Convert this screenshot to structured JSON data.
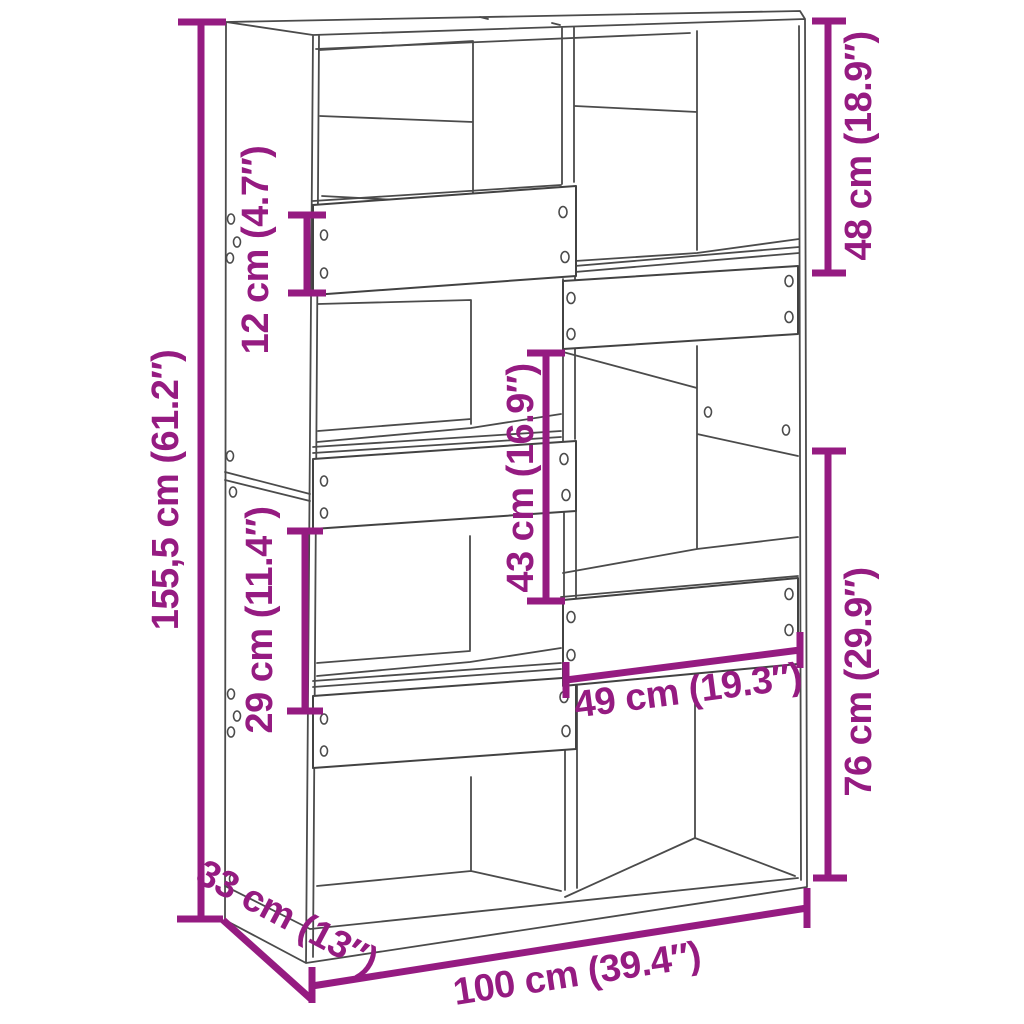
{
  "diagram": {
    "title": "room-divider bookcase dimension drawing",
    "accent_color": "#951B81",
    "line_color": "#4b4b4b",
    "background_color": "#ffffff",
    "unit_system": "cm / inches"
  },
  "dimensions": {
    "overall_height": "155,5 cm (61.2″)",
    "upper_left_gap": "12 cm (4.7″)",
    "upper_right_compartment": "48 cm (18.9″)",
    "middle_compartment": "43 cm (16.9″)",
    "middle_left_compartment": "29 cm (11.4″)",
    "lower_right_compartment": "76 cm (29.9″)",
    "inner_width": "49 cm (19.3″)",
    "depth": "33 cm (13″)",
    "overall_width": "100 cm (39.4″)"
  }
}
